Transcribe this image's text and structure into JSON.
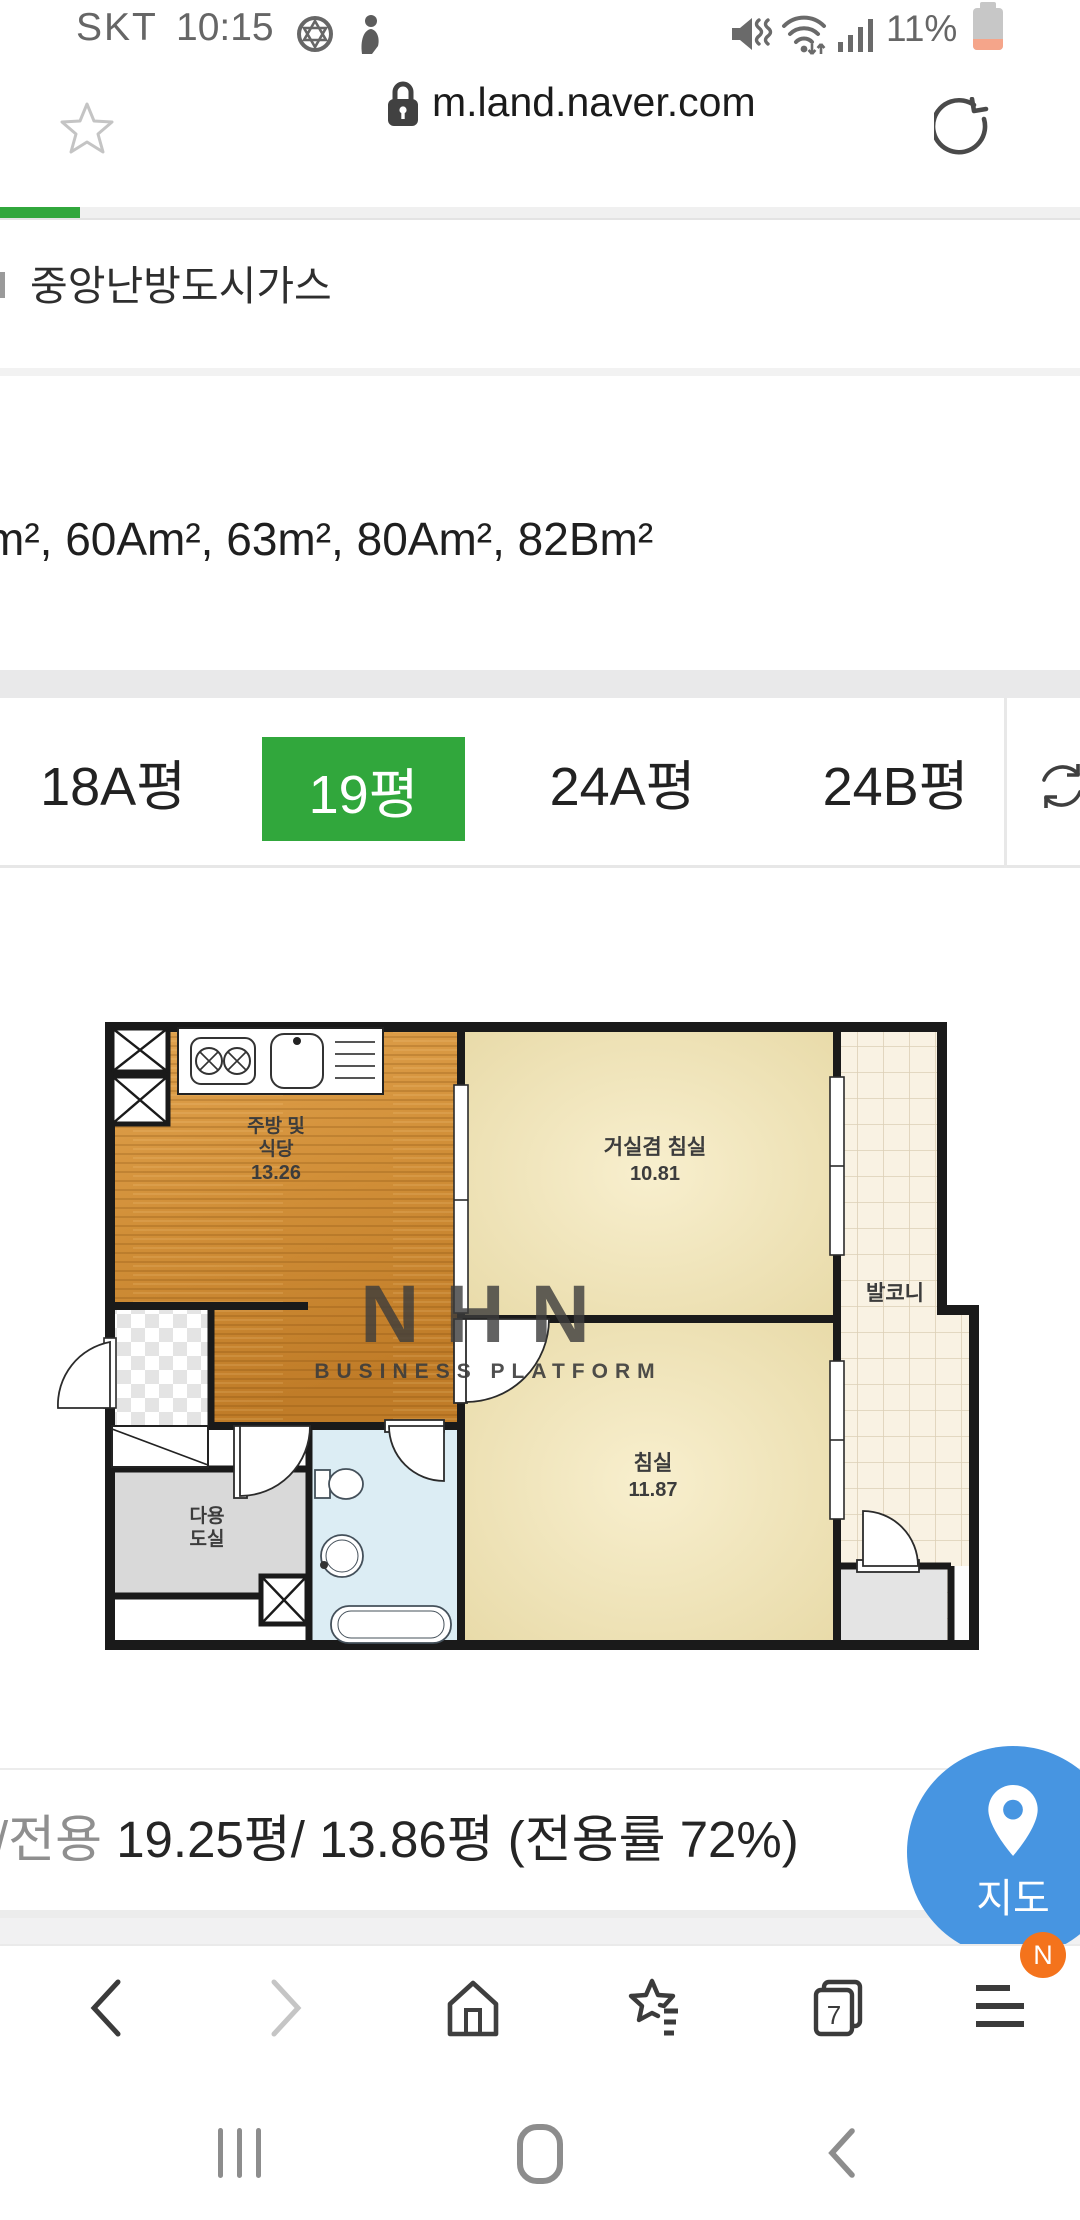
{
  "status_bar": {
    "carrier": "SKT",
    "time": "10:15",
    "battery_percent": "11%",
    "icons": [
      "hexagram-circle-icon",
      "person-icon",
      "mute-vibrate-icon",
      "wifi-icon",
      "signal-icon",
      "battery-icon"
    ]
  },
  "browser": {
    "url": "m.land.naver.com",
    "bookmark_icon": "star-outline",
    "security_icon": "lock",
    "reload_icon": "refresh"
  },
  "content": {
    "heating_label": "중앙난방도시가스",
    "area_list": "m², 60Am², 63m², 80Am², 82Bm²",
    "tabs": [
      {
        "label": "18A평",
        "active": false
      },
      {
        "label": "19평",
        "active": true
      },
      {
        "label": "24A평",
        "active": false
      },
      {
        "label": "24B평",
        "active": false
      }
    ],
    "summary_gray": "/전용",
    "summary_main": "19.25평/ 13.86평 (전용률 72%)",
    "map_button_label": "지도"
  },
  "floorplan": {
    "kitchen_line1": "주방 및",
    "kitchen_line2": "식당",
    "kitchen_area": "13.26",
    "living_name": "거실겸 침실",
    "living_area": "10.81",
    "bedroom_name": "침실",
    "bedroom_area": "11.87",
    "balcony_name": "발코니",
    "utility_line1": "다용",
    "utility_line2": "도실",
    "watermark_line1": "NHN",
    "watermark_line2": "BUSINESS PLATFORM"
  },
  "toolbar": {
    "tab_count": "7",
    "menu_badge": "N"
  },
  "colors": {
    "accent_green": "#31a73c",
    "map_blue": "#4795e1",
    "badge_orange": "#f4731c",
    "battery_low": "#f5a58a"
  }
}
